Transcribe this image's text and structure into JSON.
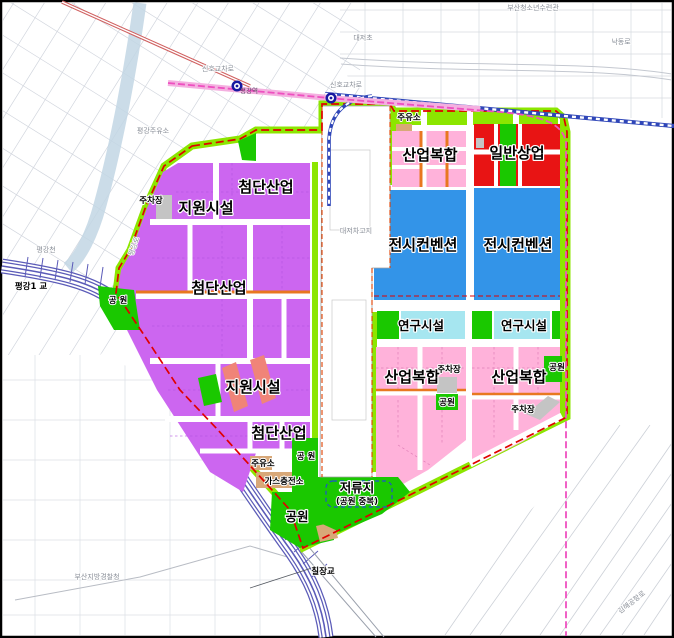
{
  "map": {
    "labels": [
      {
        "id": "busan-youth-center",
        "text": "부산청소년수련관",
        "x": 533,
        "y": 10,
        "cls": "t"
      },
      {
        "id": "daejeo-elementary",
        "text": "대저초",
        "x": 363,
        "y": 40,
        "cls": "t"
      },
      {
        "id": "nakdong-ro",
        "text": "낙동로",
        "x": 621,
        "y": 44,
        "cls": "t"
      },
      {
        "id": "signal-crossing-left",
        "text": "신호교차로",
        "x": 218,
        "y": 71,
        "cls": "t"
      },
      {
        "id": "signal-crossing-right",
        "text": "신호교차로",
        "x": 346,
        "y": 87,
        "cls": "t"
      },
      {
        "id": "pyeonggang-station",
        "text": "평강역",
        "x": 249,
        "y": 93,
        "cls": "tp"
      },
      {
        "id": "pyeonggang-gas-station",
        "text": "평강주유소",
        "x": 153,
        "y": 133,
        "cls": "t"
      },
      {
        "id": "pyeonggang-stream",
        "text": "평강천",
        "x": 46,
        "y": 252,
        "cls": "t"
      },
      {
        "id": "pyeonggang-ro",
        "text": "평강로",
        "x": 136,
        "y": 247,
        "cls": "t",
        "rot": -70
      },
      {
        "id": "daejeo-depot",
        "text": "대저차고지",
        "x": 356,
        "y": 233,
        "cls": "t"
      },
      {
        "id": "busan-police",
        "text": "부산지방경찰청",
        "x": 97,
        "y": 579,
        "cls": "t"
      },
      {
        "id": "gimhae-airport-ro",
        "text": "김해공항로",
        "x": 633,
        "y": 604,
        "cls": "t",
        "rot": -38
      },
      {
        "id": "bridge-pyeonggang1",
        "text": "평강1 교",
        "x": 31,
        "y": 289,
        "cls": "s"
      },
      {
        "id": "bridge-chiljang",
        "text": "칠장교",
        "x": 323,
        "y": 574,
        "cls": "s"
      },
      {
        "id": "parking-nw",
        "text": "주차장",
        "x": 151,
        "y": 203,
        "cls": "s"
      },
      {
        "id": "gas-station-west",
        "text": "주유소",
        "x": 263,
        "y": 466,
        "cls": "s"
      },
      {
        "id": "gas-charging-station",
        "text": "가스충전소",
        "x": 284,
        "y": 484,
        "cls": "s"
      },
      {
        "id": "park-west",
        "text": "공 원",
        "x": 118,
        "y": 303,
        "cls": "s"
      },
      {
        "id": "park-mid-small",
        "text": "공 원",
        "x": 306,
        "y": 459,
        "cls": "s"
      },
      {
        "id": "gas-station-top",
        "text": "주유소",
        "x": 409,
        "y": 120,
        "cls": "s"
      },
      {
        "id": "parking-center-left",
        "text": "주차장",
        "x": 449,
        "y": 372,
        "cls": "s"
      },
      {
        "id": "park-center-left",
        "text": "공원",
        "x": 447,
        "y": 405,
        "cls": "s"
      },
      {
        "id": "parking-center-right",
        "text": "주차장",
        "x": 523,
        "y": 412,
        "cls": "s"
      },
      {
        "id": "park-center-right",
        "text": "공원",
        "x": 557,
        "y": 370,
        "cls": "s"
      },
      {
        "id": "retention-sub",
        "text": "(공원 중복)",
        "x": 357,
        "y": 504,
        "cls": "s"
      },
      {
        "id": "park-south",
        "text": "공원",
        "x": 297,
        "y": 521,
        "cls": "z2"
      },
      {
        "id": "retention-basin",
        "text": "저류지",
        "x": 357,
        "y": 492,
        "cls": "z2"
      },
      {
        "id": "research-left",
        "text": "연구시설",
        "x": 421,
        "y": 330,
        "cls": "z2"
      },
      {
        "id": "research-right",
        "text": "연구시설",
        "x": 524,
        "y": 330,
        "cls": "z2"
      },
      {
        "id": "hightech-top",
        "text": "첨단산업",
        "x": 266,
        "y": 192,
        "cls": "z1"
      },
      {
        "id": "hightech-mid",
        "text": "첨단산업",
        "x": 219,
        "y": 293,
        "cls": "z1"
      },
      {
        "id": "hightech-bottom",
        "text": "첨단산업",
        "x": 279,
        "y": 438,
        "cls": "z1"
      },
      {
        "id": "support-nw",
        "text": "지원시설",
        "x": 206,
        "y": 213,
        "cls": "z1"
      },
      {
        "id": "support-mid",
        "text": "지원시설",
        "x": 253,
        "y": 392,
        "cls": "z1"
      },
      {
        "id": "industrial-top",
        "text": "산업복합",
        "x": 430,
        "y": 160,
        "cls": "z1"
      },
      {
        "id": "commercial-general",
        "text": "일반상업",
        "x": 517,
        "y": 158,
        "cls": "z1"
      },
      {
        "id": "convention-left",
        "text": "전시컨벤션",
        "x": 423,
        "y": 250,
        "cls": "z1"
      },
      {
        "id": "convention-right",
        "text": "전시컨벤션",
        "x": 518,
        "y": 250,
        "cls": "z1"
      },
      {
        "id": "industrial-bottom-left",
        "text": "산업복합",
        "x": 412,
        "y": 382,
        "cls": "z1"
      },
      {
        "id": "industrial-bottom-right",
        "text": "산업복합",
        "x": 519,
        "y": 382,
        "cls": "z1"
      }
    ]
  },
  "colors": {
    "hightech_industry": "#cc66f0",
    "support_facility": "#f08478",
    "industrial_complex": "#ffb2da",
    "general_commercial": "#e81414",
    "exhibition_convention": "#3394e8",
    "research_facility": "#a6e6f0",
    "park": "#1ac800",
    "green_buffer": "#8ce600",
    "parking": "#c4c4c4",
    "fuel_station": "#d8a878",
    "internal_road_accent": "#e87820",
    "site_boundary": "#e00000",
    "metro_line": "#ee50c0",
    "railway": "#2f46b8",
    "expressway": "#5b5bb8",
    "stream": "#c2d6e4"
  }
}
